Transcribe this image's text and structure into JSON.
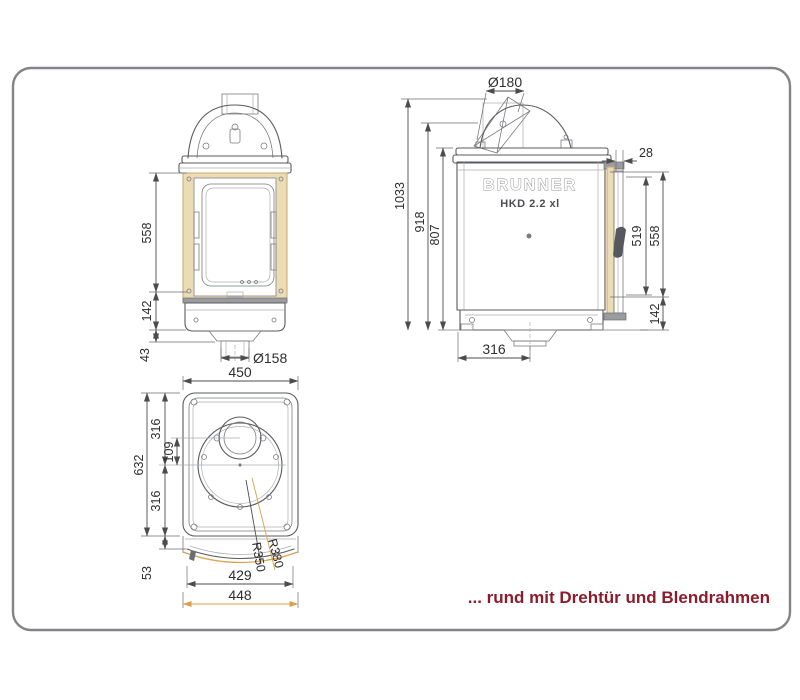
{
  "meta": {
    "caption": "... rund mit Drehtür und Blendrahmen"
  },
  "logo": {
    "brand": "BRUNNER",
    "model": "HKD 2.2 xl"
  },
  "colors": {
    "accent_orange": "#E0930F",
    "caption_red": "#8C1C2C",
    "frame_tan": "#ECDCB6",
    "line_gray": "#5a5b5e"
  },
  "front_view": {
    "dims": {
      "glass_height": "558",
      "base_height": "142",
      "foot_height": "43",
      "flue_diameter": "Ø158"
    }
  },
  "side_view": {
    "dims": {
      "total_height": "1033",
      "flue_connector_height": "918",
      "body_height": "807",
      "flue_diameter": "Ø180",
      "frame_offset": "28",
      "glass_height": "519",
      "door_height": "558",
      "base_height": "142",
      "flue_center_offset": "316"
    }
  },
  "plan_view": {
    "dims": {
      "body_width": "450",
      "body_depth": "632",
      "rear_half_depth": "316",
      "flue_offset": "109",
      "front_half_depth": "316",
      "bow_depth": "53",
      "front_width": "429",
      "inner_radius": "R350",
      "outer_radius": "R380",
      "frame_width": "448"
    }
  }
}
